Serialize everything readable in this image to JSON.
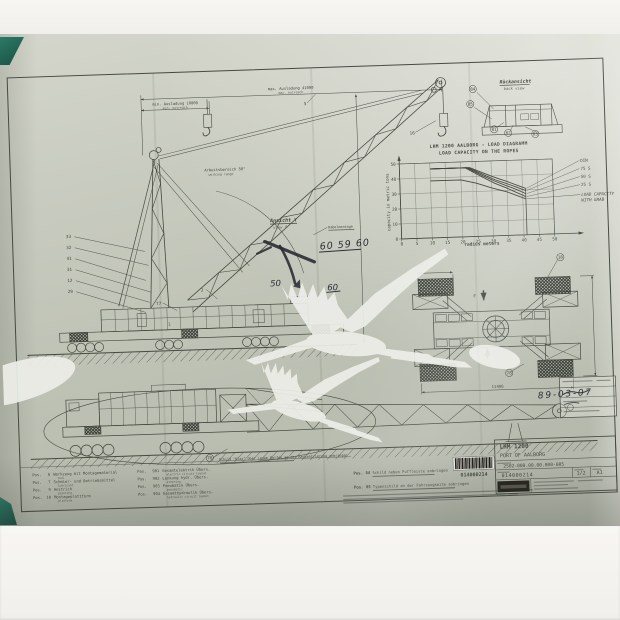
{
  "document": {
    "type": "photograph of engineering general-arrangement drawing",
    "subject": "mobile harbour crane"
  },
  "colors": {
    "paper": "#c2c5b9",
    "ink": "#454a41",
    "handwriting_ink": "#2c303a",
    "watermark": "#edeee9",
    "corner_tab": "#1f6353"
  },
  "dimensions": {
    "max_outreach_de": "max. Ausladung 41000",
    "max_outreach_en": "max. outreach",
    "min_outreach_de": "min. Ausladung 10000",
    "min_outreach_en": "min. outreach",
    "working_range_de": "Arbeitsbereich 50°",
    "working_range_en": "working range",
    "outrigger_base": "11406"
  },
  "views": {
    "view_y_de": "Ansicht Y",
    "view_y_en": "view Y",
    "rear_view_de": "Rückansicht",
    "rear_view_en": "back view",
    "cable_label": "Kabelmontage"
  },
  "handwriting": {
    "numbers": "60 59 60",
    "number_a": "60",
    "number_b": "50",
    "date": "89-03-07"
  },
  "callouts": [
    {
      "t": "5",
      "x": 311,
      "y": 71
    },
    {
      "t": "16",
      "x": 417,
      "y": 104
    },
    {
      "t": "33",
      "x": 70,
      "y": 196
    },
    {
      "t": "32",
      "x": 70,
      "y": 207
    },
    {
      "t": "41",
      "x": 70,
      "y": 218
    },
    {
      "t": "31",
      "x": 70,
      "y": 229
    },
    {
      "t": "12",
      "x": 70,
      "y": 240
    },
    {
      "t": "29",
      "x": 70,
      "y": 251
    },
    {
      "t": "2",
      "x": 202,
      "y": 254
    },
    {
      "t": "77",
      "x": 158,
      "y": 266
    },
    {
      "t": "1",
      "x": 168,
      "y": 287
    },
    {
      "t": "84",
      "x": 479,
      "y": 62,
      "c": 1
    },
    {
      "t": "85",
      "x": 476,
      "y": 77,
      "c": 1
    },
    {
      "t": "81",
      "x": 499,
      "y": 103,
      "c": 1
    },
    {
      "t": "82",
      "x": 513,
      "y": 107,
      "c": 1
    },
    {
      "t": "83",
      "x": 540,
      "y": 109,
      "c": 1
    },
    {
      "t": "18",
      "x": 561,
      "y": 233,
      "c": 1
    },
    {
      "t": "78",
      "x": 506,
      "y": 347,
      "c": 1
    },
    {
      "t": "76",
      "x": 204,
      "y": 422,
      "c": 1
    },
    {
      "t": "F",
      "x": 474,
      "y": 269
    },
    {
      "t": "F",
      "x": 476,
      "y": 324
    }
  ],
  "chart_data": {
    "type": "line",
    "title": "LHM 1200 AALBORG - LOAD DIAGRAMM",
    "subtitle": "LOAD CAPACITY ON THE ROPES",
    "xlabel": "radius meters",
    "ylabel": "capacity in metric tons",
    "xlim": [
      0,
      50
    ],
    "ylim": [
      0,
      50
    ],
    "xticks": [
      0,
      5,
      10,
      15,
      20,
      25,
      30,
      35,
      40,
      45,
      50
    ],
    "yticks": [
      0,
      10,
      20,
      30,
      40,
      50
    ],
    "grid": true,
    "max_radius_line": 41,
    "legend": [
      "DIN",
      "75 S",
      "50 S",
      "25 S",
      "LOAD CAPACITY WITH GRAB"
    ],
    "legend_position": "right",
    "series": [
      {
        "name": "DIN",
        "x": [
          10,
          23,
          27,
          31,
          35,
          38,
          41
        ],
        "y": [
          46,
          46,
          42.5,
          39,
          36,
          33.5,
          31
        ]
      },
      {
        "name": "75 S",
        "x": [
          10,
          22.5,
          27,
          31,
          35,
          38,
          41
        ],
        "y": [
          46,
          46,
          41.5,
          37.5,
          34.5,
          32,
          29.5
        ]
      },
      {
        "name": "50 S",
        "x": [
          10,
          22,
          27,
          31,
          35,
          38,
          41
        ],
        "y": [
          46,
          46,
          40.5,
          36.5,
          33,
          30.5,
          27.5
        ]
      },
      {
        "name": "25 S",
        "x": [
          10,
          21.5,
          27,
          31,
          35,
          38,
          41
        ],
        "y": [
          46,
          46,
          39.5,
          35,
          31.5,
          28.5,
          25.5
        ]
      },
      {
        "name": "LOAD CAPACITY WITH GRAB",
        "x": [
          10,
          20,
          25,
          30,
          35,
          38,
          41
        ],
        "y": [
          38,
          38,
          35.5,
          32,
          29,
          26.5,
          24
        ]
      }
    ]
  },
  "parts_list": {
    "prefix": "Pos.",
    "left": [
      {
        "num": "6",
        "de": "Werkzeug mit Montagematerial",
        "en": "tool"
      },
      {
        "num": "7",
        "de": "Schmier- und Betriebsmittel",
        "en": "lubricant"
      },
      {
        "num": "9",
        "de": "Anstrich",
        "en": "painting"
      },
      {
        "num": "10",
        "de": "Montageplattform",
        "en": "platform"
      }
    ],
    "right": [
      {
        "num": "901",
        "de": "Gesamtelektrik Übers.",
        "en": "electric circuit layout"
      },
      {
        "num": "902",
        "de": "Lenkung hydr. Übers.",
        "en": "steering"
      },
      {
        "num": "903",
        "de": "Pneumatik Übers.",
        "en": "pneumatic"
      },
      {
        "num": "904",
        "de": "Gesamthydraulik Übers.",
        "en": "hydraulic circuit layout"
      }
    ]
  },
  "notes": {
    "transport": "Schild \"Klax\" über jedem Reifen an der Radzentrierung anbringen",
    "pos84_label": "Pos. 84",
    "pos84": "Schild neben Puffleiste anbringen",
    "pos85_label": "Pos. 85",
    "pos85": "Typenschild an der Fahrzeugseite anbringen"
  },
  "title_block": {
    "model": "LHM 1200",
    "project": "PORT OF AALBORG",
    "drawing_no": "2502-000.00.00.000-005",
    "doc_no": "014000214",
    "sheet": "1/2",
    "format": "A1"
  },
  "barcode": {
    "value": "014000214"
  }
}
